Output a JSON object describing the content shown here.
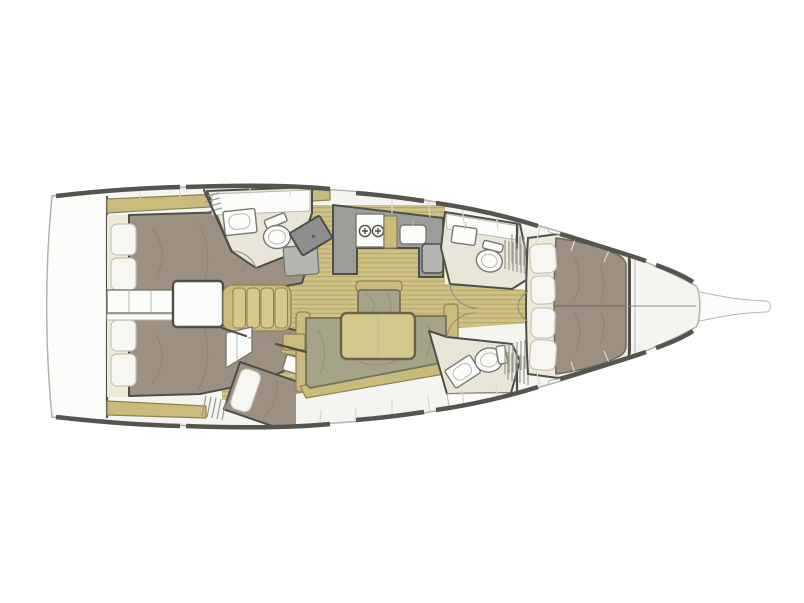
{
  "canvas": {
    "width": 804,
    "height": 603,
    "background": "#ffffff"
  },
  "diagram": {
    "type": "yacht-interior-floorplan",
    "orientation": "bow-right",
    "visible_counts": {
      "cabins": 4,
      "heads": 3,
      "double-berths": 4,
      "settees": 2,
      "tables": 2
    },
    "rooms": [
      "swim-platform-transom",
      "aft-cabin-starboard",
      "aft-cabin-port",
      "companionway-steps",
      "engine-compartment",
      "aft-head-starboard",
      "nav-station",
      "galley",
      "salon",
      "mid-cabin-port",
      "forward-head-starboard",
      "forward-head-port",
      "forward-cabin",
      "anchor-locker",
      "bowsprit"
    ],
    "fixtures": [
      "stove-2-burner",
      "galley-sink",
      "fridge",
      "toilet",
      "washbasin",
      "salon-table",
      "u-shaped-settee",
      "centerline-bench",
      "four-seat-sofa",
      "chart-desk",
      "nav-seat",
      "deck-hatches",
      "hull-windows",
      "louvered-lockers"
    ]
  },
  "colors": {
    "line": "#4e4e4a",
    "line-soft": "#b4b3ac",
    "hull-dark": "#55544e",
    "deck": "#f4f4f0",
    "seam": "#d9d8d2",
    "fixture": "#fcfcfa",
    "fixture-line": "#79786f",
    "soft-line": "#b9b7ae",
    "wood-base": "#cdc183",
    "wood-stripe": "#b2a566",
    "khaki": "#c8bb7b",
    "khaki-light": "#d4c88c",
    "khaki-line": "#8d8252",
    "table-line": "#6b6243",
    "mattress": "#9c9083",
    "matt-line": "#6b675f",
    "bedbase": "#eee9d8",
    "pillow": "#f7f6f1",
    "pillow-line": "#c6c3b8",
    "head-floor": "#e9e5d9",
    "counter": "#9c9c99",
    "counter-dark": "#8e8e8c",
    "seat-gray": "#b5b5b2",
    "cushion": "#a5a489",
    "cushion-line": "#73735c",
    "arc": "#8f8e86",
    "hatch": "#9a998f",
    "wrinkle": "#857a6d",
    "wrinkle-olive": "#84846b"
  }
}
